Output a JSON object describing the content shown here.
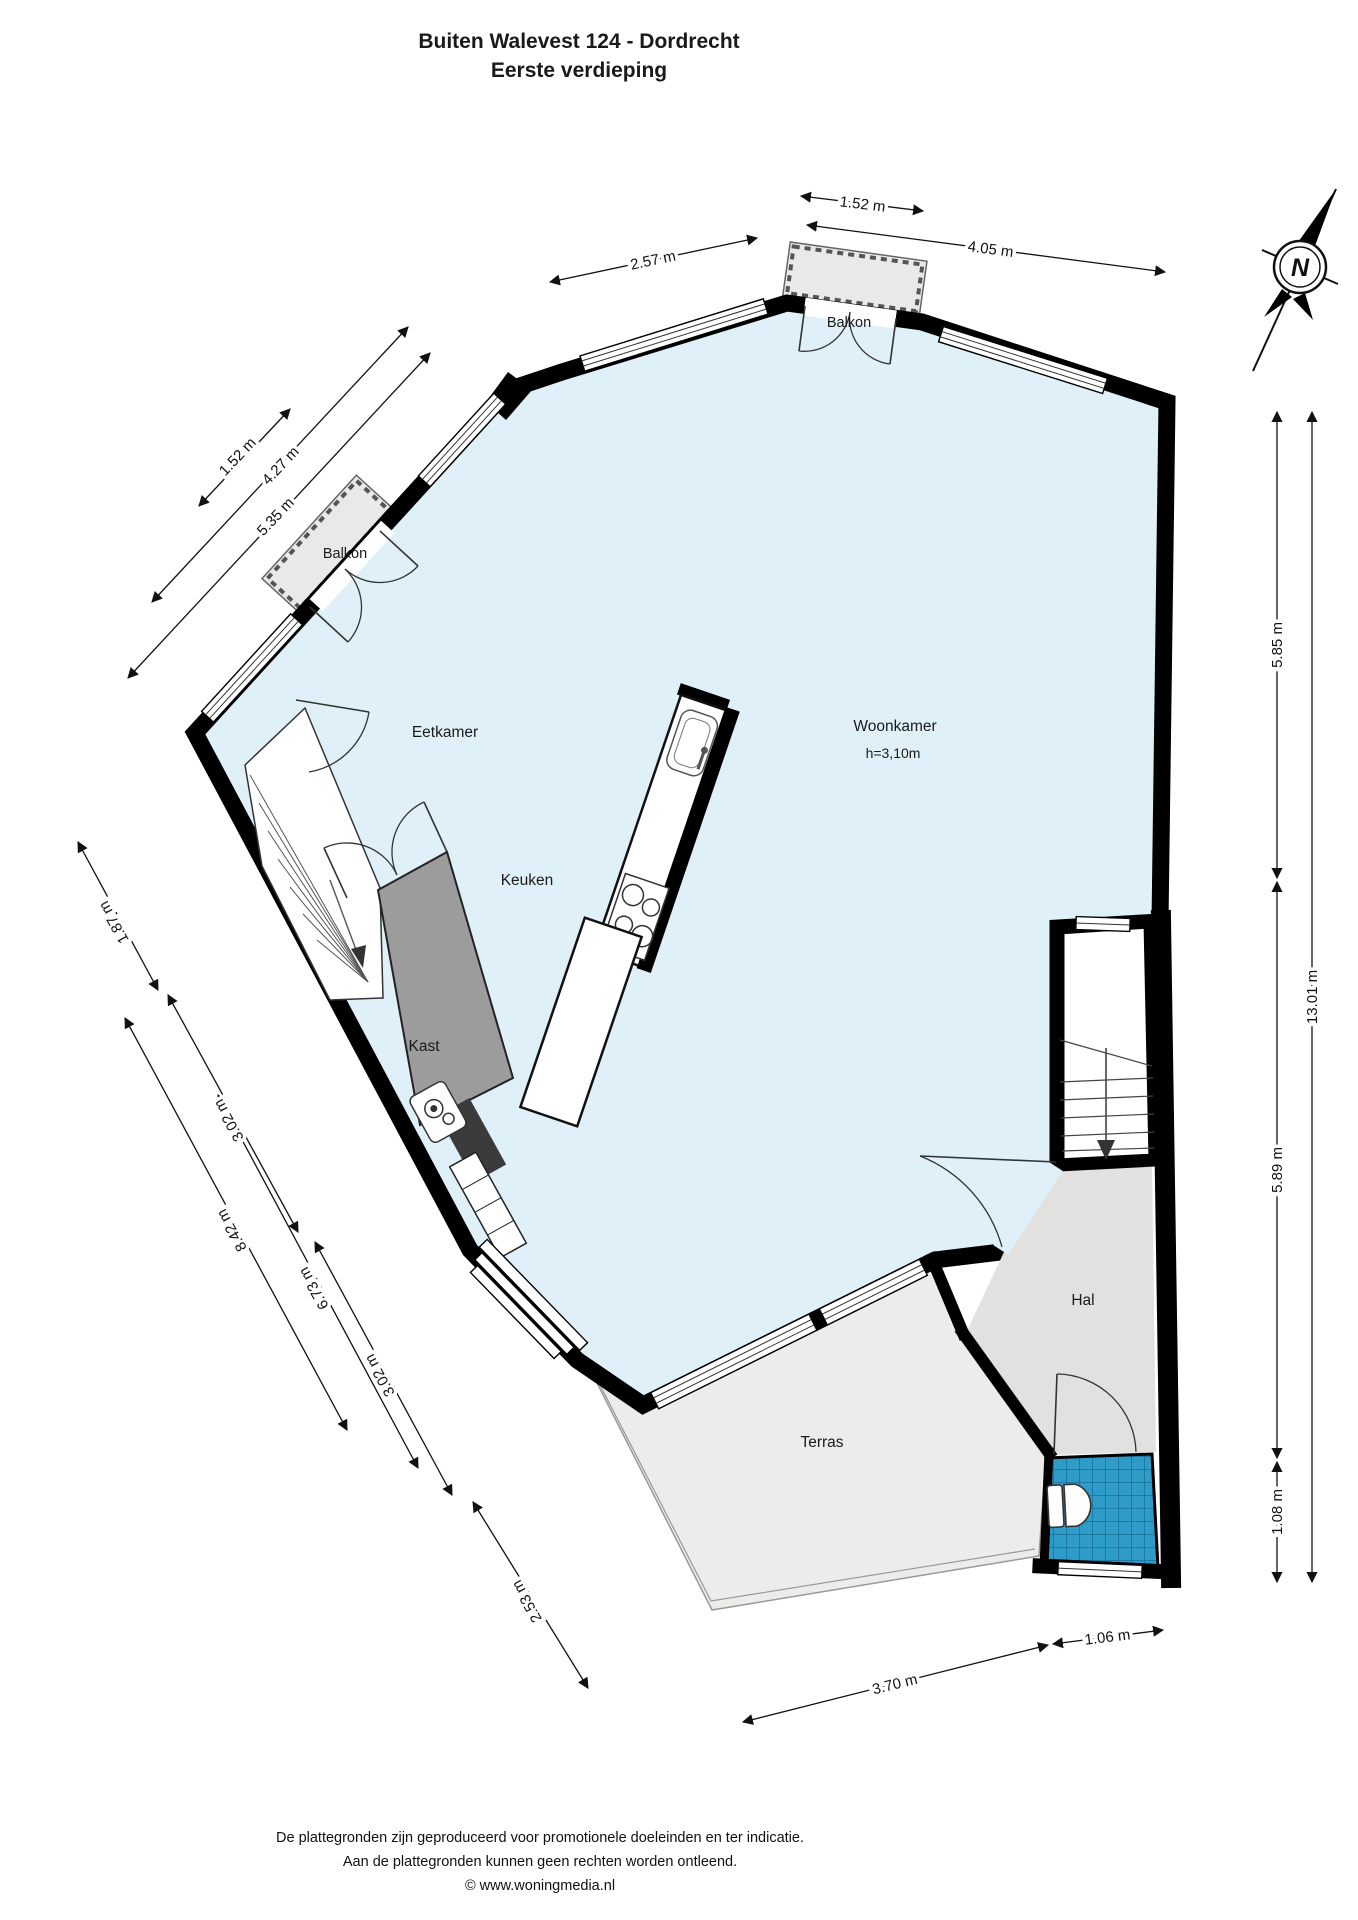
{
  "title": {
    "line1": "Buiten Walevest 124 - Dordrecht",
    "line2": "Eerste verdieping"
  },
  "rooms": {
    "eetkamer": "Eetkamer",
    "keuken": "Keuken",
    "woonkamer": "Woonkamer",
    "woonkamer_height": "h=3,10m",
    "kast": "Kast",
    "hal": "Hal",
    "terras": "Terras",
    "balkon_top": "Balkon",
    "balkon_left": "Balkon"
  },
  "dims": {
    "top_152": "1.52 m",
    "top_257": "2.57 m",
    "top_405": "4.05 m",
    "left_152": "1.52 m",
    "left_427": "4.27 m",
    "left_535": "5.35 m",
    "sw_187": "1.87 m",
    "sw_302a": "3.02 m",
    "sw_842": "8.42 m",
    "sw_673": "6.73 m",
    "sw_302b": "3.02 m",
    "sw_253": "2.53 m",
    "bottom_370": "3.70 m",
    "bottom_106": "1.06 m",
    "right_585": "5.85 m",
    "right_1301": "13.01 m",
    "right_589": "5.89 m",
    "right_108": "1.08 m"
  },
  "compass": {
    "north": "N"
  },
  "footer": {
    "line1": "De plattegronden zijn geproduceerd voor promotionele doeleinden en ter indicatie.",
    "line2": "Aan de plattegronden kunnen geen rechten worden ontleend.",
    "line3": "© www.woningmedia.nl"
  },
  "colors": {
    "room_fill": "#dff0f8",
    "wall": "#000000",
    "hal_fill": "#e2e1df",
    "kast_fill": "#9c9c9c",
    "terras_fill": "#ececea",
    "toilet_tile": "#2e9bc9",
    "dark_unit": "#3b3b3b"
  }
}
